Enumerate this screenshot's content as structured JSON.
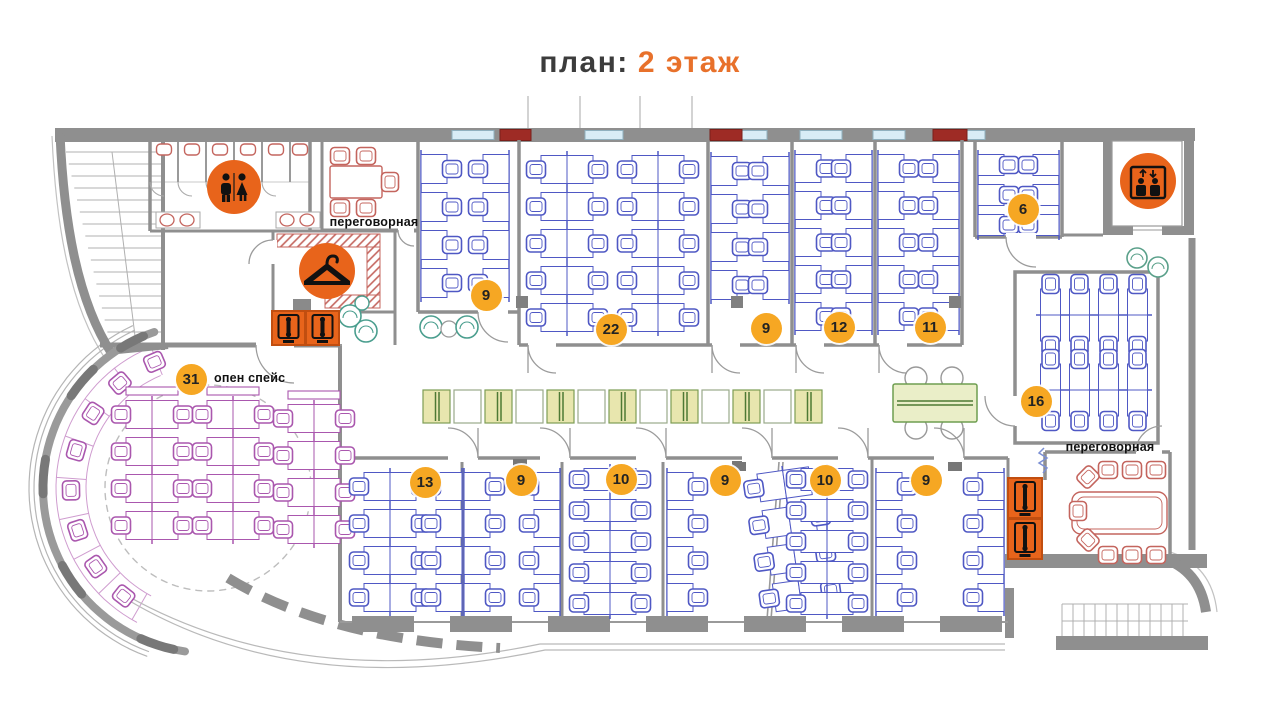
{
  "title": {
    "prefix": "план:",
    "highlight": "2 этаж"
  },
  "labels": [
    {
      "id": "meeting-room-top",
      "text": "переговорная",
      "x": 374,
      "y": 222
    },
    {
      "id": "open-space",
      "text": "опен спейс",
      "x": 214,
      "y": 378,
      "align": "left"
    },
    {
      "id": "meeting-room-right",
      "text": "переговорная",
      "x": 1110,
      "y": 447
    }
  ],
  "badges": [
    {
      "room": "open-space",
      "number": "31",
      "x": 191,
      "y": 379
    },
    {
      "room": "office-top-1",
      "number": "9",
      "x": 486,
      "y": 295
    },
    {
      "room": "office-top-2",
      "number": "22",
      "x": 611,
      "y": 329
    },
    {
      "room": "office-top-3",
      "number": "9",
      "x": 766,
      "y": 328
    },
    {
      "room": "office-top-4",
      "number": "12",
      "x": 839,
      "y": 327
    },
    {
      "room": "office-top-5",
      "number": "11",
      "x": 930,
      "y": 327
    },
    {
      "room": "office-top-6",
      "number": "6",
      "x": 1023,
      "y": 209
    },
    {
      "room": "office-right",
      "number": "16",
      "x": 1036,
      "y": 401
    },
    {
      "room": "office-bot-1",
      "number": "13",
      "x": 425,
      "y": 482
    },
    {
      "room": "office-bot-2",
      "number": "9",
      "x": 521,
      "y": 480
    },
    {
      "room": "office-bot-3",
      "number": "10",
      "x": 621,
      "y": 479
    },
    {
      "room": "office-bot-4",
      "number": "9",
      "x": 725,
      "y": 480
    },
    {
      "room": "office-bot-5",
      "number": "10",
      "x": 825,
      "y": 480
    },
    {
      "room": "office-bot-6",
      "number": "9",
      "x": 926,
      "y": 480
    }
  ],
  "icons": [
    {
      "type": "wc",
      "x": 234,
      "y": 187
    },
    {
      "type": "coat-check",
      "x": 327,
      "y": 271
    },
    {
      "type": "elevator",
      "x": 1148,
      "y": 181
    },
    {
      "type": "phone-booth",
      "x": 272,
      "y": 311,
      "w": 33,
      "h": 34
    },
    {
      "type": "phone-booth",
      "x": 306,
      "y": 311,
      "w": 33,
      "h": 34
    },
    {
      "type": "phone-booth",
      "x": 1008,
      "y": 478,
      "w": 34,
      "h": 40
    },
    {
      "type": "phone-booth",
      "x": 1008,
      "y": 519,
      "w": 34,
      "h": 40
    }
  ],
  "colors": {
    "badge": "#F6A723",
    "icon_orange": "#E8641B",
    "icon_border": "#C14E10",
    "desk_blue": "#4F58C4",
    "desk_purple": "#AA57AE",
    "desk_red": "#C4655E",
    "wall": "#8F8F8F",
    "wall_light": "#B0B0B0",
    "accent_title": "#E8712B",
    "locker_green_fill": "#E8E6AE",
    "locker_green_line": "#4E7A34",
    "window_blue": "#D8ECF6",
    "window_red": "#9E2B25",
    "lounge_teal": "#4A9E8E"
  }
}
